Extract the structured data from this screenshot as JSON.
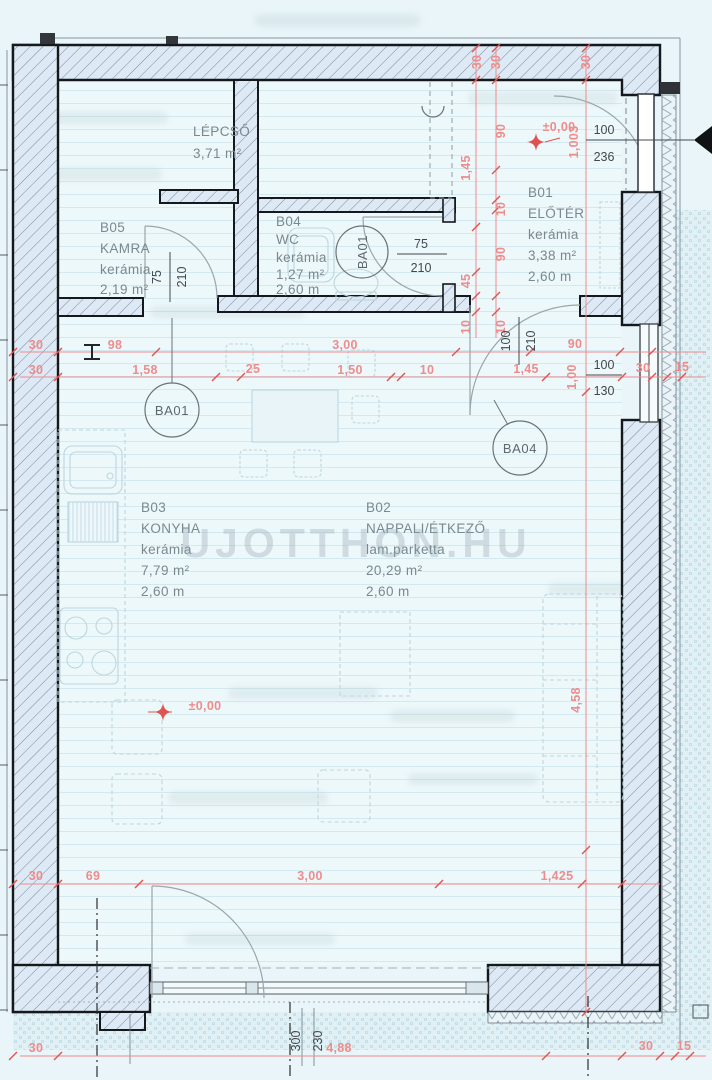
{
  "watermark": "UJOTTHON.HU",
  "colors": {
    "background": "#e9f5f9",
    "dimension_red": "#ee8c8c",
    "marker_red": "#e0524f",
    "wall_outline": "#15181c",
    "room_text": "#79898f",
    "annotation_black": "#43484d"
  },
  "rooms": {
    "lepcso": {
      "name": "LÉPCSŐ",
      "area": "3,71 m²"
    },
    "b05": {
      "code": "B05",
      "name": "KAMRA",
      "floor": "kerámia",
      "area": "2,19 m²"
    },
    "b04": {
      "code": "B04",
      "name": "WC",
      "floor": "kerámia",
      "area": "1,27 m²",
      "height": "2,60 m"
    },
    "b01": {
      "code": "B01",
      "name": "ELŐTÉR",
      "floor": "kerámia",
      "area": "3,38 m²",
      "height": "2,60 m"
    },
    "b03": {
      "code": "B03",
      "name": "KONYHA",
      "floor": "kerámia",
      "area": "7,79 m²",
      "height": "2,60 m"
    },
    "b02": {
      "code": "B02",
      "name": "NAPPALI/ÉTKEZŐ",
      "floor": "lam.parketta",
      "area": "20,29 m²",
      "height": "2,60 m"
    }
  },
  "tags": {
    "kamra_door": "BA01",
    "wc_door": "BA01",
    "living_door": "BA04"
  },
  "openings": {
    "kamra_door": {
      "width": "75",
      "height": "210"
    },
    "wc_door": {
      "width": "75",
      "height": "210"
    },
    "entry_door": {
      "width": "100",
      "height": "236"
    },
    "living_door": {
      "width": "100",
      "height": "210"
    },
    "window": {
      "width": "100",
      "height": "130"
    },
    "terrace_door": {
      "width": "300",
      "height": "230"
    }
  },
  "elevations": {
    "hall": "±0,00",
    "hall_parapet": "1,003",
    "living": "±0,00"
  },
  "dims": {
    "top_wall": [
      "30",
      "30",
      "30"
    ],
    "hall_v_a": [
      "1,45",
      "45",
      "10"
    ],
    "hall_v_b": [
      "90",
      "10",
      "90",
      "10"
    ],
    "mid_upper": [
      "30",
      "98",
      "3,00",
      "90"
    ],
    "mid_lower": [
      "30",
      "1,58",
      "25",
      "1,50",
      "10",
      "1,45"
    ],
    "mid_right": [
      "1,00",
      "30",
      "15"
    ],
    "right_v": [
      "4,58"
    ],
    "bottom_inner": [
      "30",
      "69",
      "3,00",
      "1,425"
    ],
    "bottom_outer": [
      "30",
      "4,88",
      "30",
      "15"
    ]
  }
}
